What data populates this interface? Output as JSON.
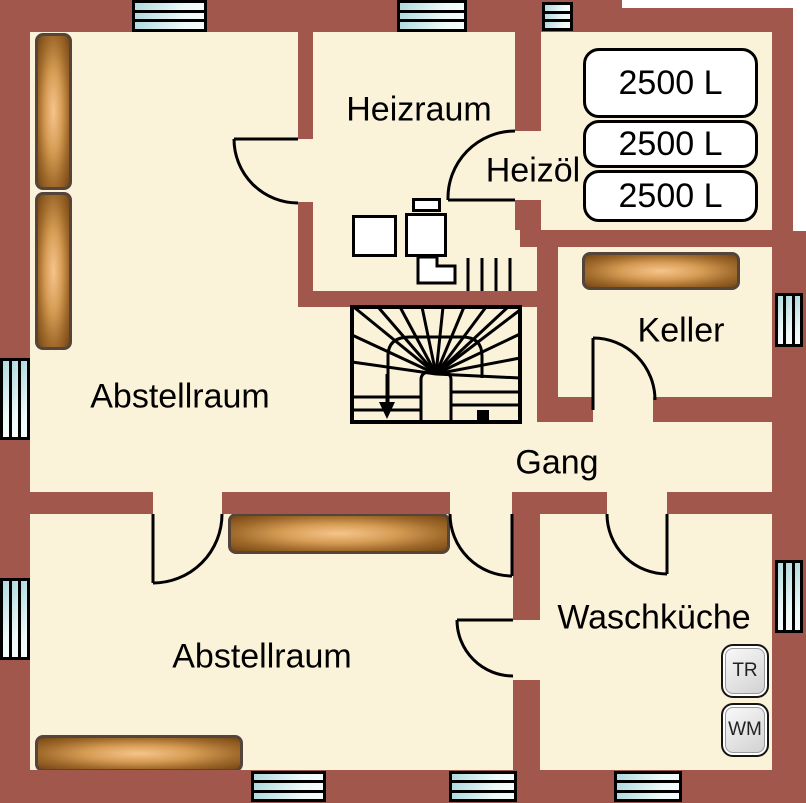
{
  "plan": {
    "rooms": {
      "heizraum": "Heizraum",
      "heizoel": "Heizöl",
      "keller": "Keller",
      "gang": "Gang",
      "waschkueche": "Waschküche",
      "abstellraum_nw": "Abstellraum",
      "abstellraum_sw": "Abstellraum"
    },
    "tanks": [
      "2500 L",
      "2500 L",
      "2500 L"
    ],
    "appliances": {
      "dryer": "TR",
      "washer": "WM"
    },
    "colors": {
      "wall": "#a1574c",
      "floor": "#fbf2da",
      "window_glass": "#cfe9ec",
      "shelf_highlight": "#f6c58c",
      "shelf_dark": "#764715",
      "line": "#000000"
    }
  }
}
